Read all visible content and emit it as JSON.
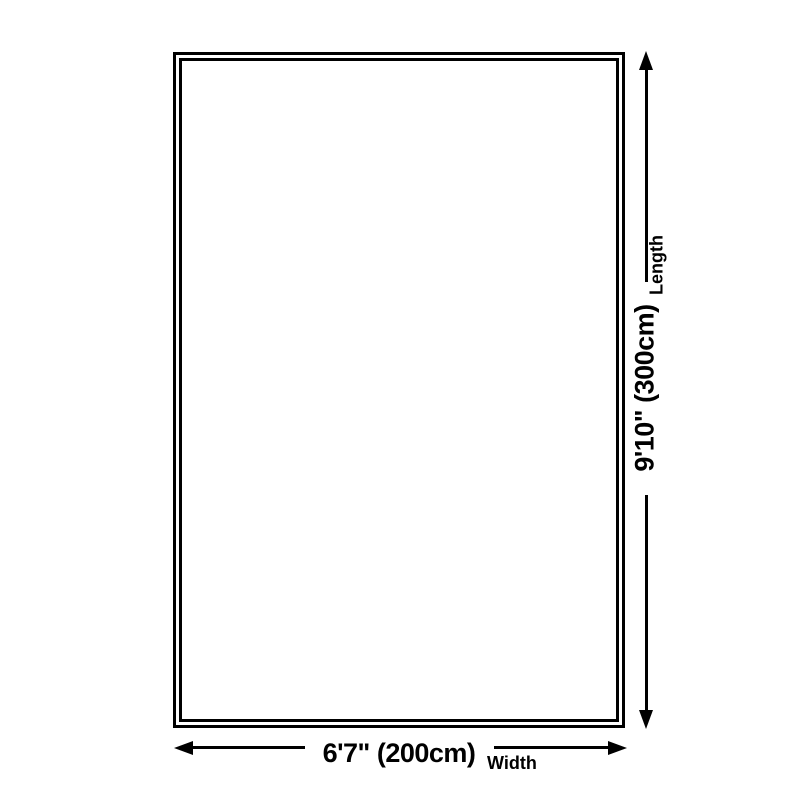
{
  "diagram": {
    "type": "product-dimension-diagram",
    "dimensions": {
      "width": {
        "value": "6'7\" (200cm)",
        "label": "Width"
      },
      "length": {
        "value": "9'10\" (300cm)",
        "label": "Length"
      }
    },
    "colors": {
      "line": "#000000",
      "background": "#ffffff"
    },
    "icons": [
      "arrow-up-icon",
      "arrow-down-icon",
      "arrow-left-icon",
      "arrow-right-icon"
    ]
  }
}
